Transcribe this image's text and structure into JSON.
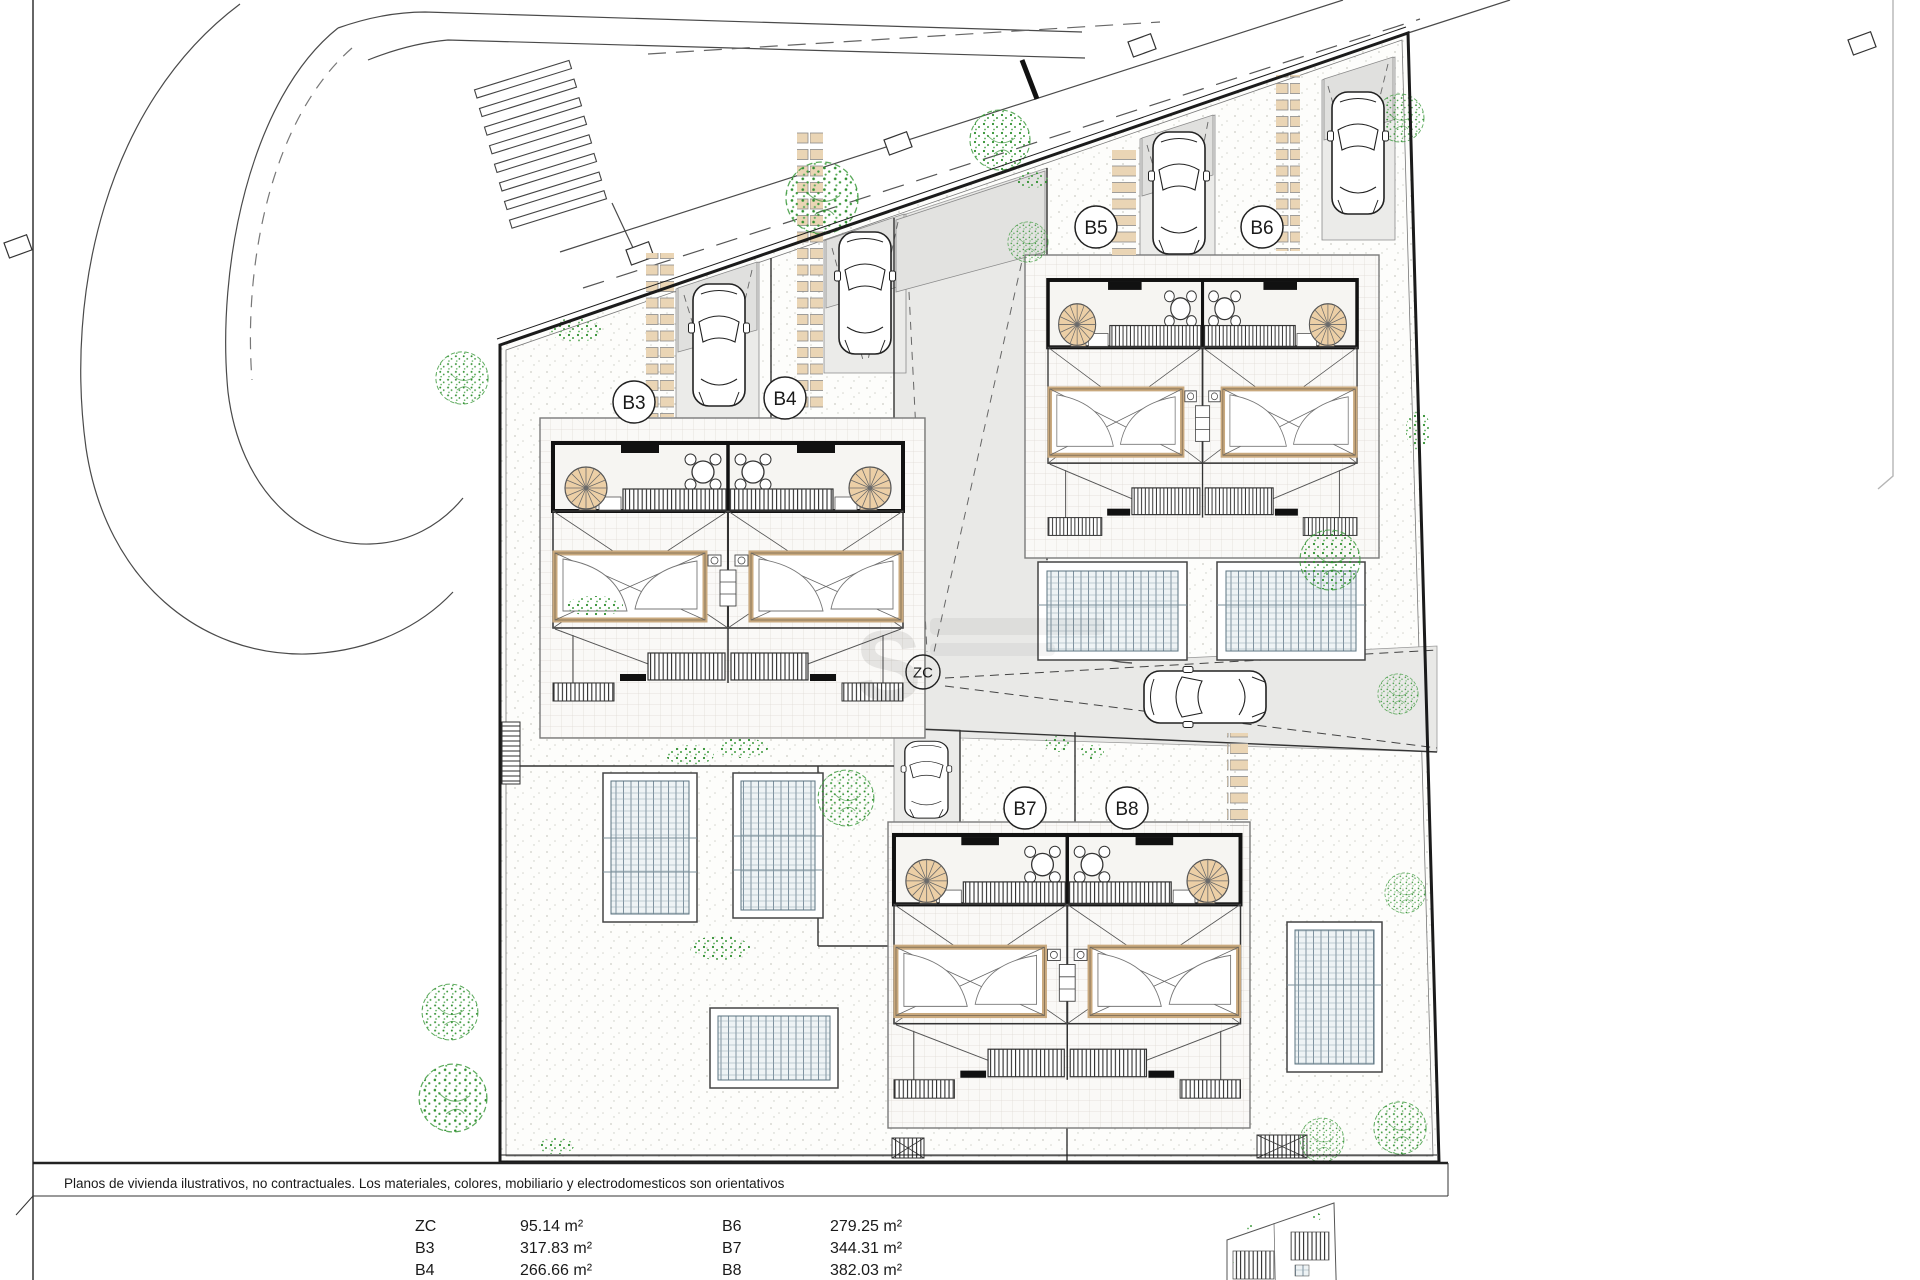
{
  "sheet": {
    "disclaimer": "Planos de vivienda ilustrativos, no contractuales. Los materiales, colores, mobiliario y electrodomesticos son orientativos",
    "watermark_letter": "S"
  },
  "labels": {
    "b3": "B3",
    "b4": "B4",
    "b5": "B5",
    "b6": "B6",
    "b7": "B7",
    "b8": "B8",
    "zc": "ZC"
  },
  "legend": {
    "rows": [
      {
        "code": "ZC",
        "area": "95.14 m²"
      },
      {
        "code": "B3",
        "area": "317.83 m²"
      },
      {
        "code": "B4",
        "area": "266.66 m²"
      },
      {
        "code": "B6",
        "area": "279.25 m²"
      },
      {
        "code": "B7",
        "area": "344.31 m²"
      },
      {
        "code": "B8",
        "area": "382.03 m²"
      }
    ]
  },
  "colors": {
    "tan": "#ead5b5",
    "stair_tan": "#eccfa6",
    "canopy_frame": "#c9a97e",
    "corridor_gray": "#e9e9e7",
    "pool_tint": "#eef3f5",
    "tree_green": "#2f8f2f",
    "line_dark": "#1b1b1b"
  }
}
